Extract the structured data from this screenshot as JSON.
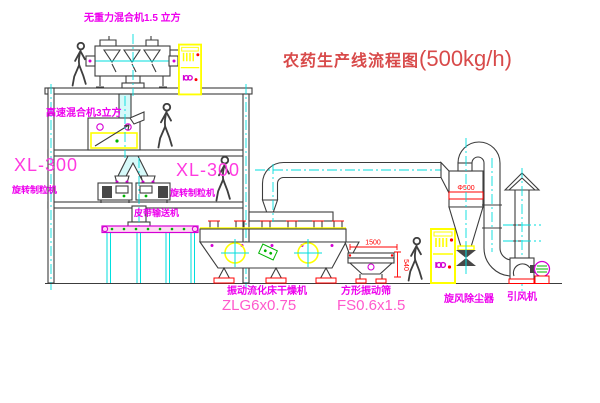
{
  "title": {
    "text": "农药生产线流程图",
    "capacity": "(500kg/h)"
  },
  "equipment_labels": {
    "gravity_free_mixer": "无重力混合机1.5 立方",
    "high_speed_mixer": "高速混合机3立方",
    "granulator_left_model": "XL-300",
    "granulator_left_name": "旋转制粒机",
    "granulator_right_model": "XL-300",
    "granulator_right_name": "旋转制粒机",
    "belt_conveyor": "皮带输送机",
    "fluid_bed_dryer": "振动流化床干燥机",
    "fluid_bed_dryer_model": "ZLG6x0.75",
    "vibrating_screen": "方形振动筛",
    "vibrating_screen_model": "FS0.6x1.5",
    "cyclone": "旋风除尘器",
    "induced_draft_fan": "引风机"
  },
  "dimensions": {
    "screen_length": "1500",
    "screen_height": "540",
    "cyclone_note": "Φ500"
  },
  "colors": {
    "label_magenta": "#ee00ee",
    "model_pink": "#ff58cc",
    "title_red": "#d84a4a",
    "line_dark": "#3c3c3c",
    "centerline_cyan": "#00dede",
    "accent_yellow": "#ffff00",
    "accent_red": "#ff0000",
    "accent_green": "#00b400"
  }
}
